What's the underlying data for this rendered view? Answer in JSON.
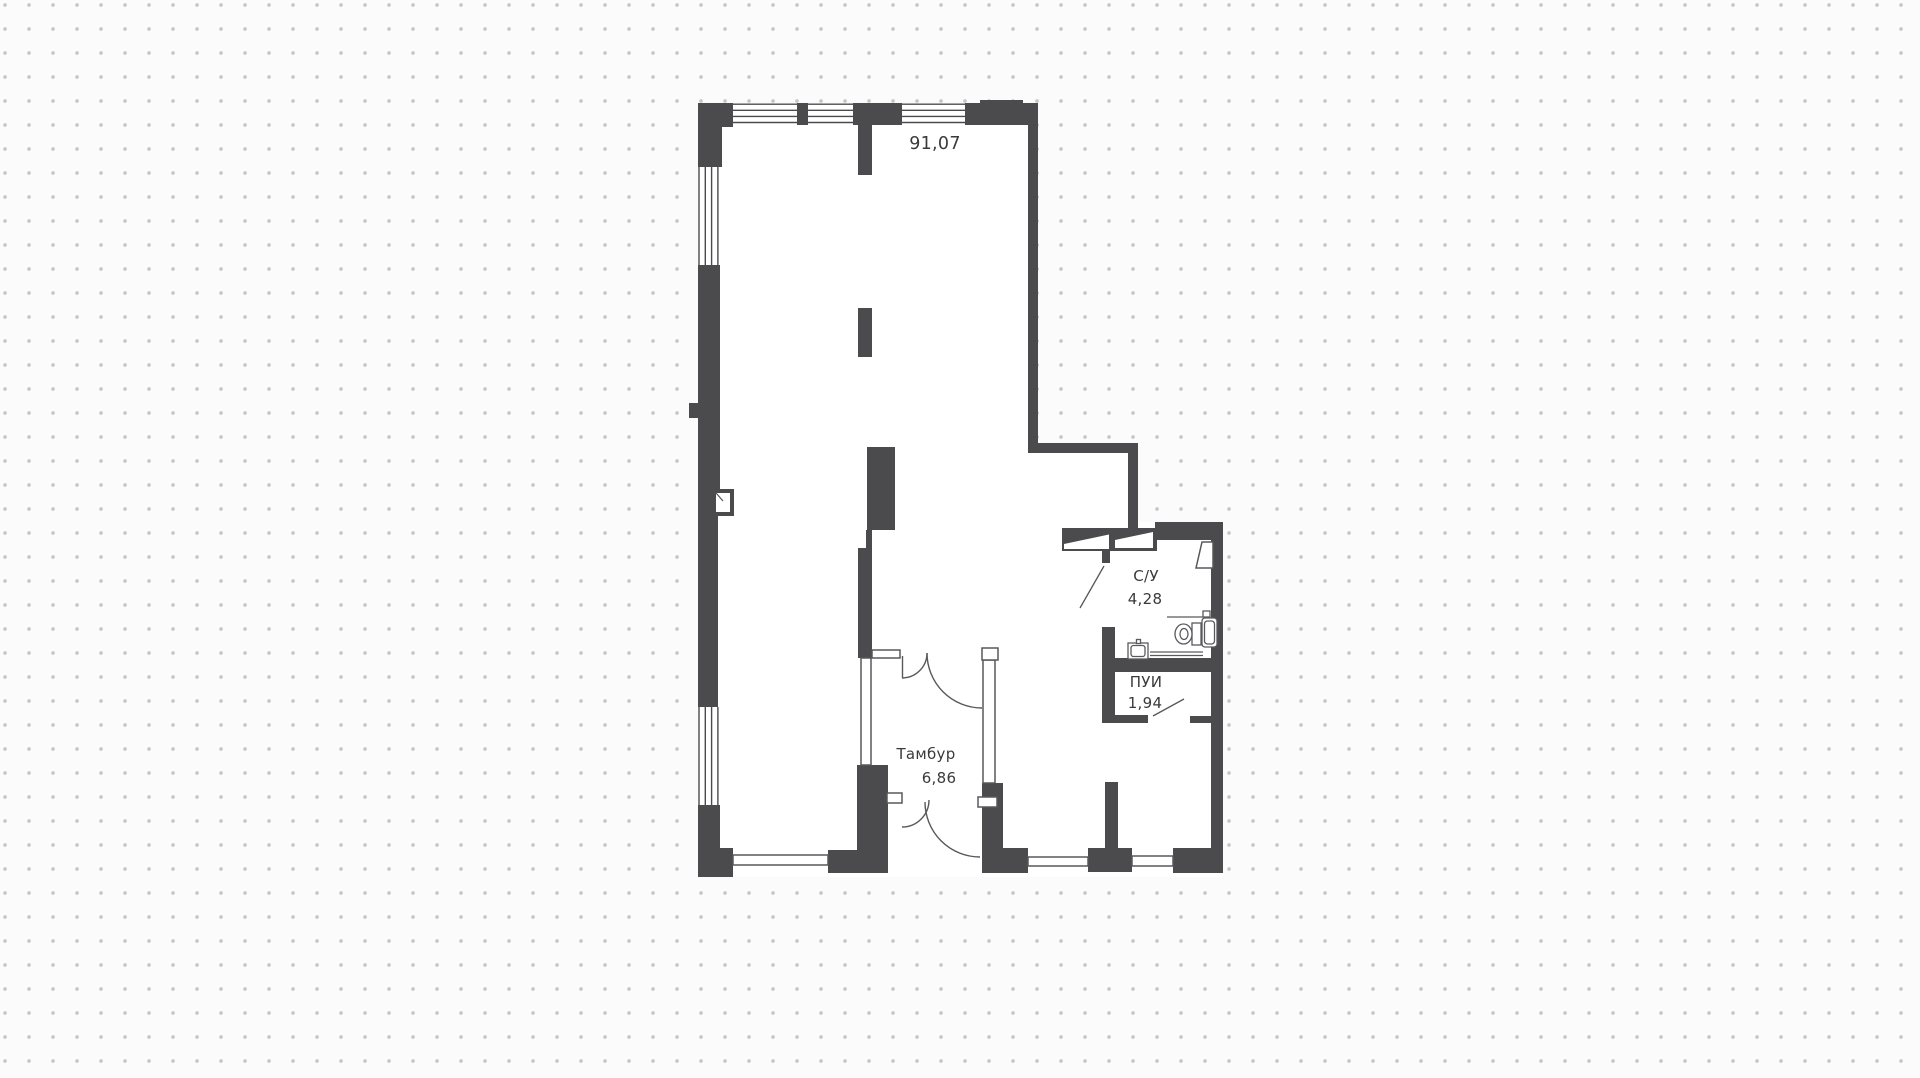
{
  "plan": {
    "main_room": {
      "area": "91,07"
    },
    "bathroom": {
      "name": "С/У",
      "area": "4,28"
    },
    "cleaning_room": {
      "name": "ПУИ",
      "area": "1,94"
    },
    "vestibule": {
      "name": "Тамбур",
      "area": "6,86"
    }
  },
  "colors": {
    "wall": "#4b4b4e",
    "line": "#58585c",
    "text": "#3a3a3c",
    "background": "#fbfbfb",
    "dot": "#c7c7c7",
    "room": "#ffffff"
  }
}
